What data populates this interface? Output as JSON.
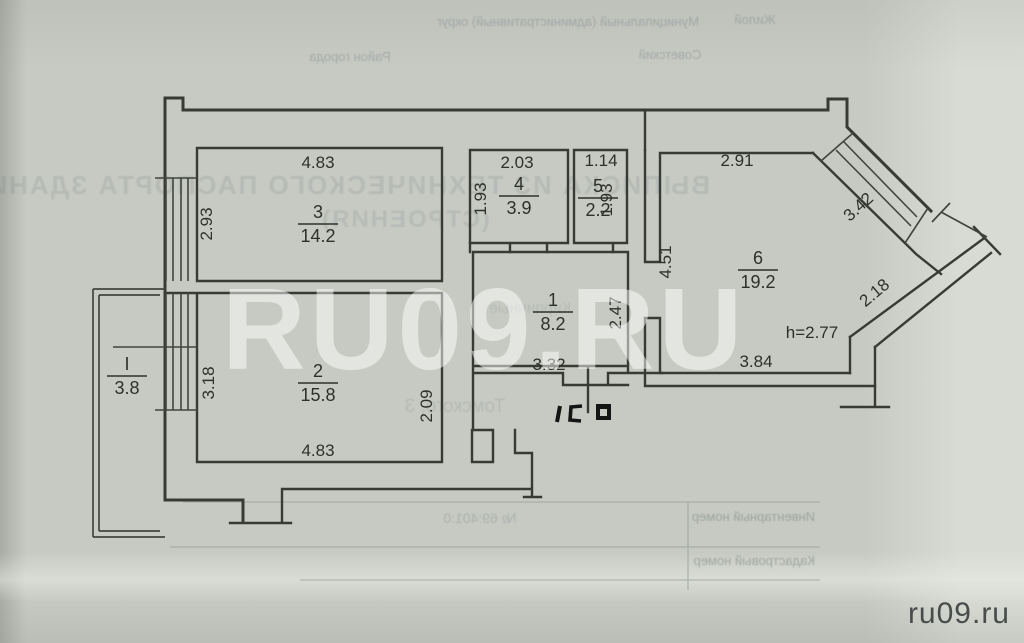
{
  "document": {
    "watermark": "RU09.RU",
    "site_logo": "ru09.ru",
    "paper_color": "#c7cac3",
    "ink_color": "#33352f"
  },
  "bleed_through": {
    "header_field1": "Муниципальный (административный) округ",
    "header_value1": "Жилой",
    "header_field2": "Район города",
    "header_value2": "Советский",
    "title_line1": "ВЫПИСКА ИЗ ТЕХНИЧЕСКОГО ПАСПОРТА ЗДАНИЯ",
    "title_line2": "(СТРОЕНИЯ)",
    "scribble_mid": "Кирпичные",
    "scribble_address": "Томского, 3",
    "table_field1": "Инвентарный номер",
    "table_field2": "Кадастровый номер",
    "table_scribble": "№ 69:401:0"
  },
  "plan": {
    "rooms": [
      {
        "num": "3",
        "area": "14.2",
        "x": 318,
        "y": 218
      },
      {
        "num": "4",
        "area": "3.9",
        "x": 519,
        "y": 190
      },
      {
        "num": "5",
        "area": "2.2",
        "x": 598,
        "y": 192
      },
      {
        "num": "6",
        "area": "19.2",
        "x": 758,
        "y": 264
      },
      {
        "num": "1",
        "area": "8.2",
        "x": 553,
        "y": 306
      },
      {
        "num": "2",
        "area": "15.8",
        "x": 318,
        "y": 377
      },
      {
        "num": "I",
        "area": "3.8",
        "x": 127,
        "y": 370
      }
    ],
    "dimensions": [
      {
        "v": "4.83",
        "x": 318,
        "y": 168
      },
      {
        "v": "2.93",
        "x": 212,
        "y": 224,
        "r": -90
      },
      {
        "v": "2.03",
        "x": 517,
        "y": 168
      },
      {
        "v": "1.93",
        "x": 486,
        "y": 199,
        "r": -90
      },
      {
        "v": "1.14",
        "x": 601,
        "y": 166
      },
      {
        "v": "1.93",
        "x": 612,
        "y": 200,
        "r": -90
      },
      {
        "v": "2.91",
        "x": 737,
        "y": 166
      },
      {
        "v": "3.42",
        "x": 862,
        "y": 211,
        "r": -42
      },
      {
        "v": "4.51",
        "x": 671,
        "y": 262,
        "r": -90
      },
      {
        "v": "2.47",
        "x": 621,
        "y": 313,
        "r": -90
      },
      {
        "v": "2.18",
        "x": 878,
        "y": 297,
        "r": -40
      },
      {
        "v": "3.84",
        "x": 756,
        "y": 367
      },
      {
        "v": "3.32",
        "x": 549,
        "y": 370
      },
      {
        "v": "3.18",
        "x": 214,
        "y": 383,
        "r": -90
      },
      {
        "v": "2.09",
        "x": 432,
        "y": 406,
        "r": -90
      },
      {
        "v": "4.83",
        "x": 318,
        "y": 456
      },
      {
        "v": "h=2.77",
        "x": 812,
        "y": 338
      }
    ]
  }
}
